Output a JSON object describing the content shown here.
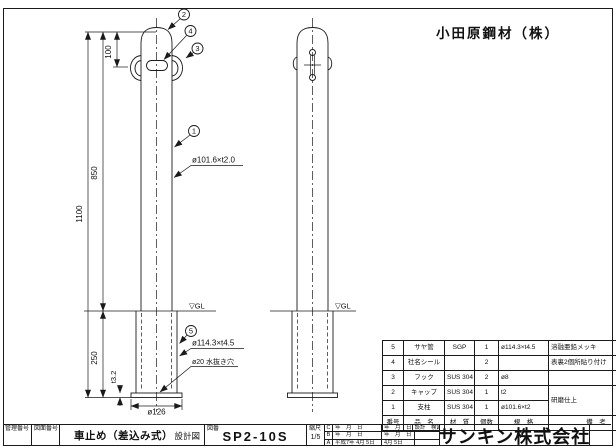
{
  "client_name": "小田原鋼材（株）",
  "drawing": {
    "balloons": {
      "b1": "1",
      "b2": "2",
      "b3": "3",
      "b4": "4",
      "b5": "5"
    },
    "dimensions": {
      "hook_offset": "100",
      "above_ground": "850",
      "total_length": "1100",
      "embed_depth": "250",
      "plate_thickness": "t3.2",
      "base_diameter": "ø126"
    },
    "labels": {
      "post_spec": "ø101.6×t2.0",
      "sleeve_spec": "ø114.3×t4.5",
      "drain_hole": "ø20 水抜き穴",
      "ground_left": "▽GL",
      "ground_right": "▽GL"
    }
  },
  "parts_table": {
    "headers": {
      "no": "番号",
      "name": "品　名",
      "material": "材　質",
      "qty": "個数",
      "spec": "規　格",
      "remarks": "備　考"
    },
    "rows": [
      {
        "no": "5",
        "name": "サヤ管",
        "material": "SGP",
        "qty": "1",
        "spec": "ø114.3×t4.5",
        "remarks": "溶融亜鉛メッキ"
      },
      {
        "no": "4",
        "name": "社名シール",
        "material": "",
        "qty": "2",
        "spec": "",
        "remarks": "表裏2個所貼り付け"
      },
      {
        "no": "3",
        "name": "フック",
        "material": "SUS 304",
        "qty": "2",
        "spec": "ø8",
        "remarks": ""
      },
      {
        "no": "2",
        "name": "キャップ",
        "material": "SUS 304",
        "qty": "1",
        "spec": "t2",
        "remarks": "研磨仕上"
      },
      {
        "no": "1",
        "name": "支柱",
        "material": "SUS 304",
        "qty": "1",
        "spec": "ø101.6×t2",
        "remarks": ""
      }
    ]
  },
  "title_block": {
    "control_no_label": "管理番号",
    "drawing_no_label": "図面番号",
    "product_name": "車止め（差込み式）",
    "drawing_type": "設計図",
    "code_label": "図番",
    "drawing_code": "SP2-10S",
    "scale_label": "縮尺",
    "scale_value": "1/5",
    "revisions": [
      {
        "mark": "C",
        "date": "年　月　日"
      },
      {
        "mark": "B",
        "date": "年　月　日"
      },
      {
        "mark": "A",
        "date": "平成7年 4月 5日"
      }
    ],
    "sign_rows": [
      {
        "date": "年　月　日",
        "note": "設計　検図"
      },
      {
        "date": "年　月　日",
        "note": ""
      },
      {
        "date": "4月 5日",
        "note": ""
      }
    ],
    "company_name": "サンキン株式会社"
  }
}
